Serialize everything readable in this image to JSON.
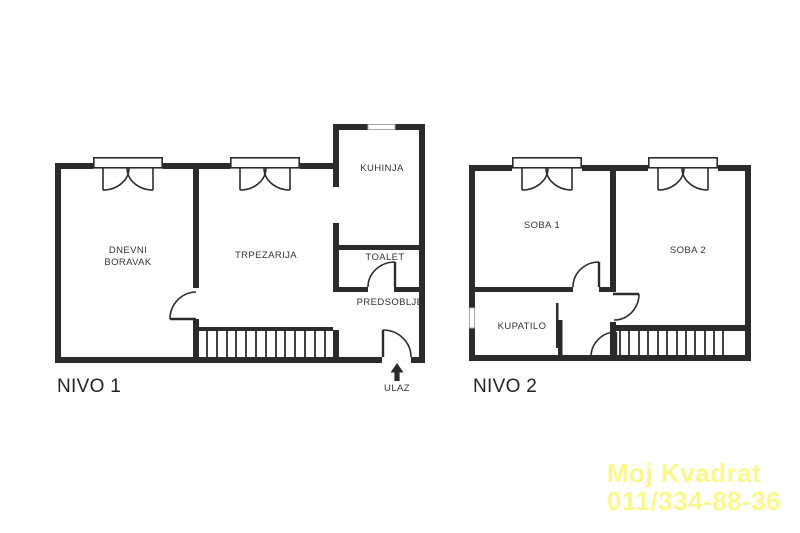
{
  "floors": {
    "nivo1": {
      "title": "NIVO 1",
      "rooms": {
        "living": "DNEVNI\nBORAVAK",
        "dining": "TRPEZARIJA",
        "kitchen": "KUHINJA",
        "toilet": "TOALET",
        "hall": "PREDSOBLJE"
      },
      "entrance_label": "ULAZ"
    },
    "nivo2": {
      "title": "NIVO 2",
      "rooms": {
        "room1": "SOBA 1",
        "room2": "SOBA 2",
        "bathroom": "KUPATILO"
      }
    }
  },
  "watermark": {
    "line1": "Moj Kvadrat",
    "line2": "011/334-88-36",
    "color": "#FAF88C"
  },
  "colors": {
    "wall": "#2b2b2b",
    "label": "#333333",
    "background": "#ffffff"
  }
}
